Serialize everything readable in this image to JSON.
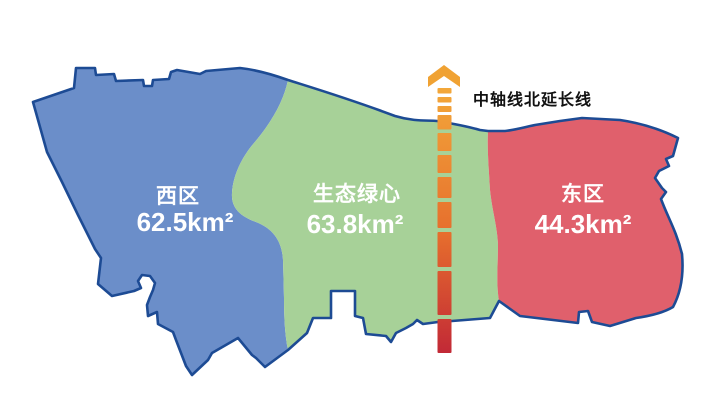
{
  "canvas": {
    "width": 718,
    "height": 407,
    "background": "#ffffff"
  },
  "map": {
    "border_color": "#1d4b94",
    "label_text_color": "#ffffff",
    "regions": [
      {
        "id": "west",
        "name": "西区",
        "area": "62.5km²",
        "fill": "#6b8ec9"
      },
      {
        "id": "green-heart",
        "name": "生态绿心",
        "area": "63.8km²",
        "fill": "#a7d198"
      },
      {
        "id": "east",
        "name": "东区",
        "area": "44.3km²",
        "fill": "#e0606c"
      }
    ]
  },
  "axis": {
    "label": "中轴线北延长线",
    "label_color": "#111111",
    "arrow_color": "#f0a233",
    "gradient": [
      "#f3a83a",
      "#e66e2d",
      "#c22936"
    ]
  }
}
